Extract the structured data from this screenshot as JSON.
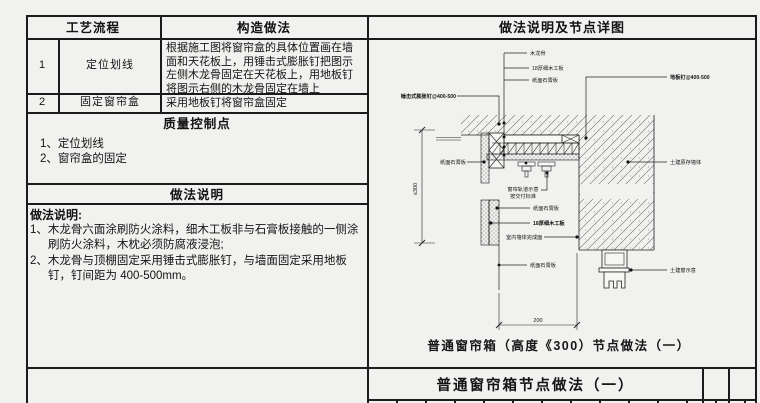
{
  "left_table": {
    "col_headers": {
      "process": "工艺流程",
      "method": "构造做法"
    },
    "rows": [
      {
        "no": "1",
        "name": "定位划线",
        "desc": "根据施工图将窗帘盒的具体位置画在墙面和天花板上，用锤击式膨胀钉把图示左侧木龙骨固定在天花板上，用地板钉将图示右侧的木龙骨固定在墙上"
      },
      {
        "no": "2",
        "name": "固定窗帘盒",
        "desc": "采用地板钉将窗帘盒固定"
      }
    ],
    "quality": {
      "header": "质量控制点",
      "items": [
        "1、定位划线",
        "2、窗帘盒的固定"
      ]
    },
    "notes": {
      "header": "做法说明",
      "heading": "做法说明:",
      "items": [
        "1、木龙骨六面涂刷防火涂料，细木工板非与石膏板接触的一侧涂刷防火涂料，木枕必须防腐液浸泡;",
        "2、木龙骨与顶棚固定采用锤击式膨胀钉，与墙面固定采用地板钉，钉间距为 400-500mm。"
      ]
    }
  },
  "right_panel": {
    "header": "做法说明及节点详图",
    "caption": "普通窗帘箱（高度《300）节点做法（一）",
    "sheet_title": "普通窗帘箱节点做法（一）",
    "diagram": {
      "labels": {
        "wood_keel": "木龙骨",
        "blockboard": "18厚细木工板",
        "gypsum_board": "纸面石膏板",
        "floor_nail": "地板钉@400-500",
        "expansion_nail": "锤击式膨胀钉@400-500",
        "existing_wall": "土建原存墙体",
        "track_note_line1": "窗帘轨道示意",
        "track_note_line2": "按交付标准",
        "gypsum_board_left": "纸面石膏板",
        "gypsum_board_2": "纸面石膏板",
        "blockboard_2": "18厚细木工板",
        "interior_wall_finish": "室内墙体完成面",
        "gypsum_board_3": "纸面石膏板",
        "civil_window": "土建窗示意",
        "dim_vertical": "≤300",
        "dim_horizontal": "200"
      }
    }
  }
}
